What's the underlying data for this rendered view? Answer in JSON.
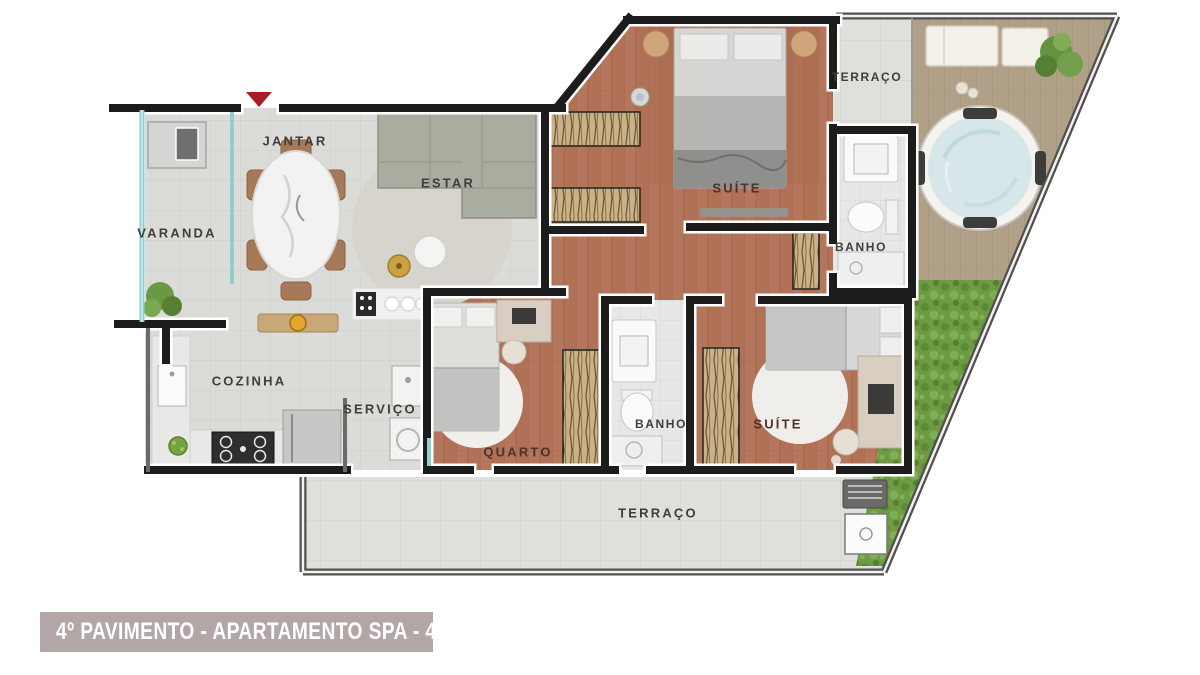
{
  "floor_plan": {
    "rooms": [
      {
        "id": "varanda",
        "label": "VARANDA"
      },
      {
        "id": "jantar",
        "label": "JANTAR"
      },
      {
        "id": "estar",
        "label": "ESTAR"
      },
      {
        "id": "cozinha",
        "label": "COZINHA"
      },
      {
        "id": "servico",
        "label": "SERVIÇO"
      },
      {
        "id": "quarto",
        "label": "QUARTO"
      },
      {
        "id": "banho-social",
        "label": "BANHO"
      },
      {
        "id": "suite-master",
        "label": "SUÍTE"
      },
      {
        "id": "banho-suite",
        "label": "BANHO"
      },
      {
        "id": "suite-2",
        "label": "SUÍTE"
      },
      {
        "id": "terraco-top",
        "label": "TERRAÇO"
      },
      {
        "id": "terraco-bottom",
        "label": "TERRAÇO"
      }
    ],
    "entry_marker": {
      "icon": "entry-arrow-icon",
      "color": "#a61e22"
    }
  },
  "caption": {
    "text": "4º PAVIMENTO - APARTAMENTO SPA - 402",
    "bar_color": "#b3a6a6",
    "text_color": "#ffffff"
  },
  "colors": {
    "wall": "#1c1c1c",
    "wood_floor": "#b4775d",
    "social_tile": "#dbdbd8",
    "bath_tile": "#e6e8e5",
    "terrace_tile": "#dfdfdc",
    "deck_wood": "#b1a088",
    "hedge_green": "#6d9a43",
    "spa_water": "#d6e6e9",
    "sofa_gray": "#a9ada0",
    "glass_teal": "#8fcdd0"
  }
}
